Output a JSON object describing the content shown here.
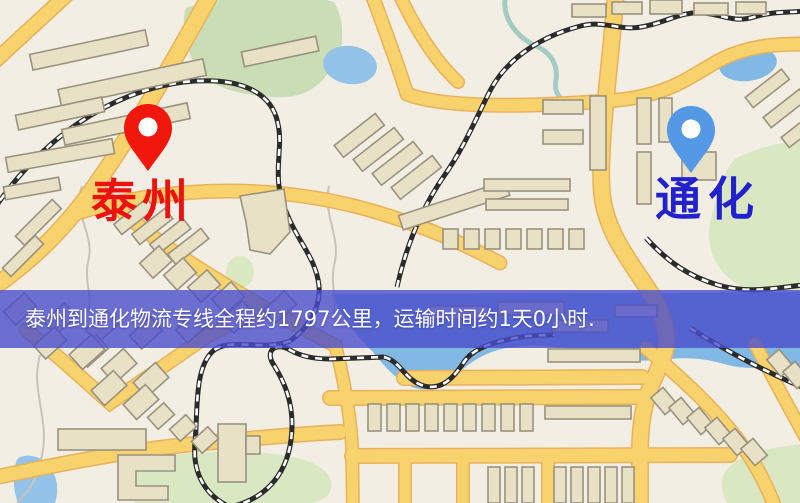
{
  "route_banner": {
    "text": "泰州到通化物流专线全程约1797公里，运输时间约1天0小时.",
    "distance": "约1797公里",
    "duration": "约1天0小时"
  },
  "map": {
    "origin": {
      "label": "泰州"
    },
    "destination": {
      "label": "通化"
    }
  },
  "theme": {
    "map_bg": "#F3EEE4",
    "park": "#D9E8C2",
    "park_dark": "#CBDDB4",
    "water": "#82B9E4",
    "water_light": "#93C3E8",
    "road_fill": "#F8D26C",
    "road_casing": "#E8B25C",
    "building_fill": "#E9E1C6",
    "building_stroke": "#99927F",
    "rail_dark": "#2B2B2B",
    "rail_light": "#FFFFFF",
    "stream": "#C9C4B6",
    "river": "#A5CBC5",
    "banner_bg": "#4A4ECB",
    "banner_text": "#FFFFFF",
    "origin_marker": "#F2170C",
    "origin_label": "#EE1111",
    "destination_marker": "#5598E6",
    "destination_label": "#2222CC"
  }
}
